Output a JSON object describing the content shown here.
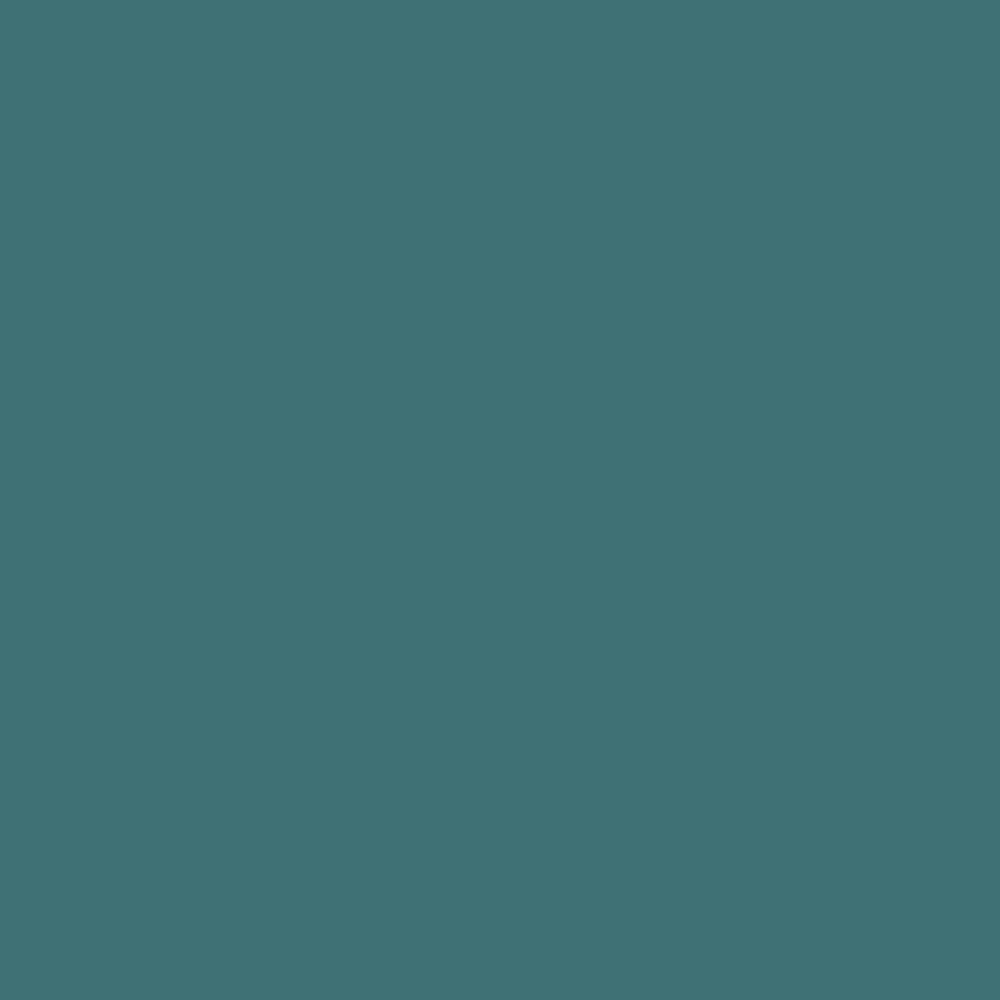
{
  "canvas": {
    "background_color": "#3f7175"
  }
}
